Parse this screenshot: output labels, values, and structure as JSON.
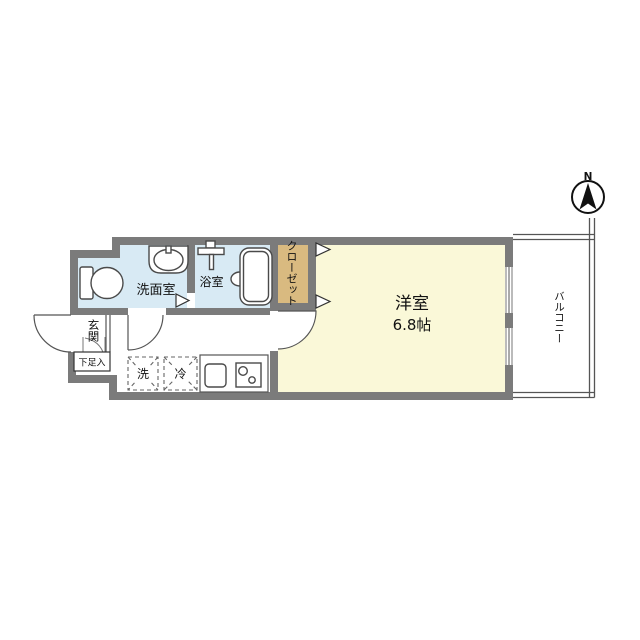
{
  "plan": {
    "compass": {
      "north_label": "N"
    },
    "rooms": {
      "main_room": {
        "name": "洋室",
        "size": "6.8帖"
      },
      "balcony": {
        "name": "バルコニー"
      },
      "closet": {
        "name": "クローゼット"
      },
      "bathroom": {
        "name": "浴室"
      },
      "washroom": {
        "name": "洗面室"
      },
      "entrance": {
        "name": "玄関"
      },
      "shoe_cabinet": {
        "name": "下足入"
      },
      "washer_space": {
        "name": "洗"
      },
      "fridge_space": {
        "name": "冷"
      }
    },
    "colors": {
      "wall": "#7b7b7b",
      "main_room_fill": "#faf8d8",
      "wet_area_fill": "#d8eaf4",
      "closet_fill": "#d9ba80"
    }
  }
}
